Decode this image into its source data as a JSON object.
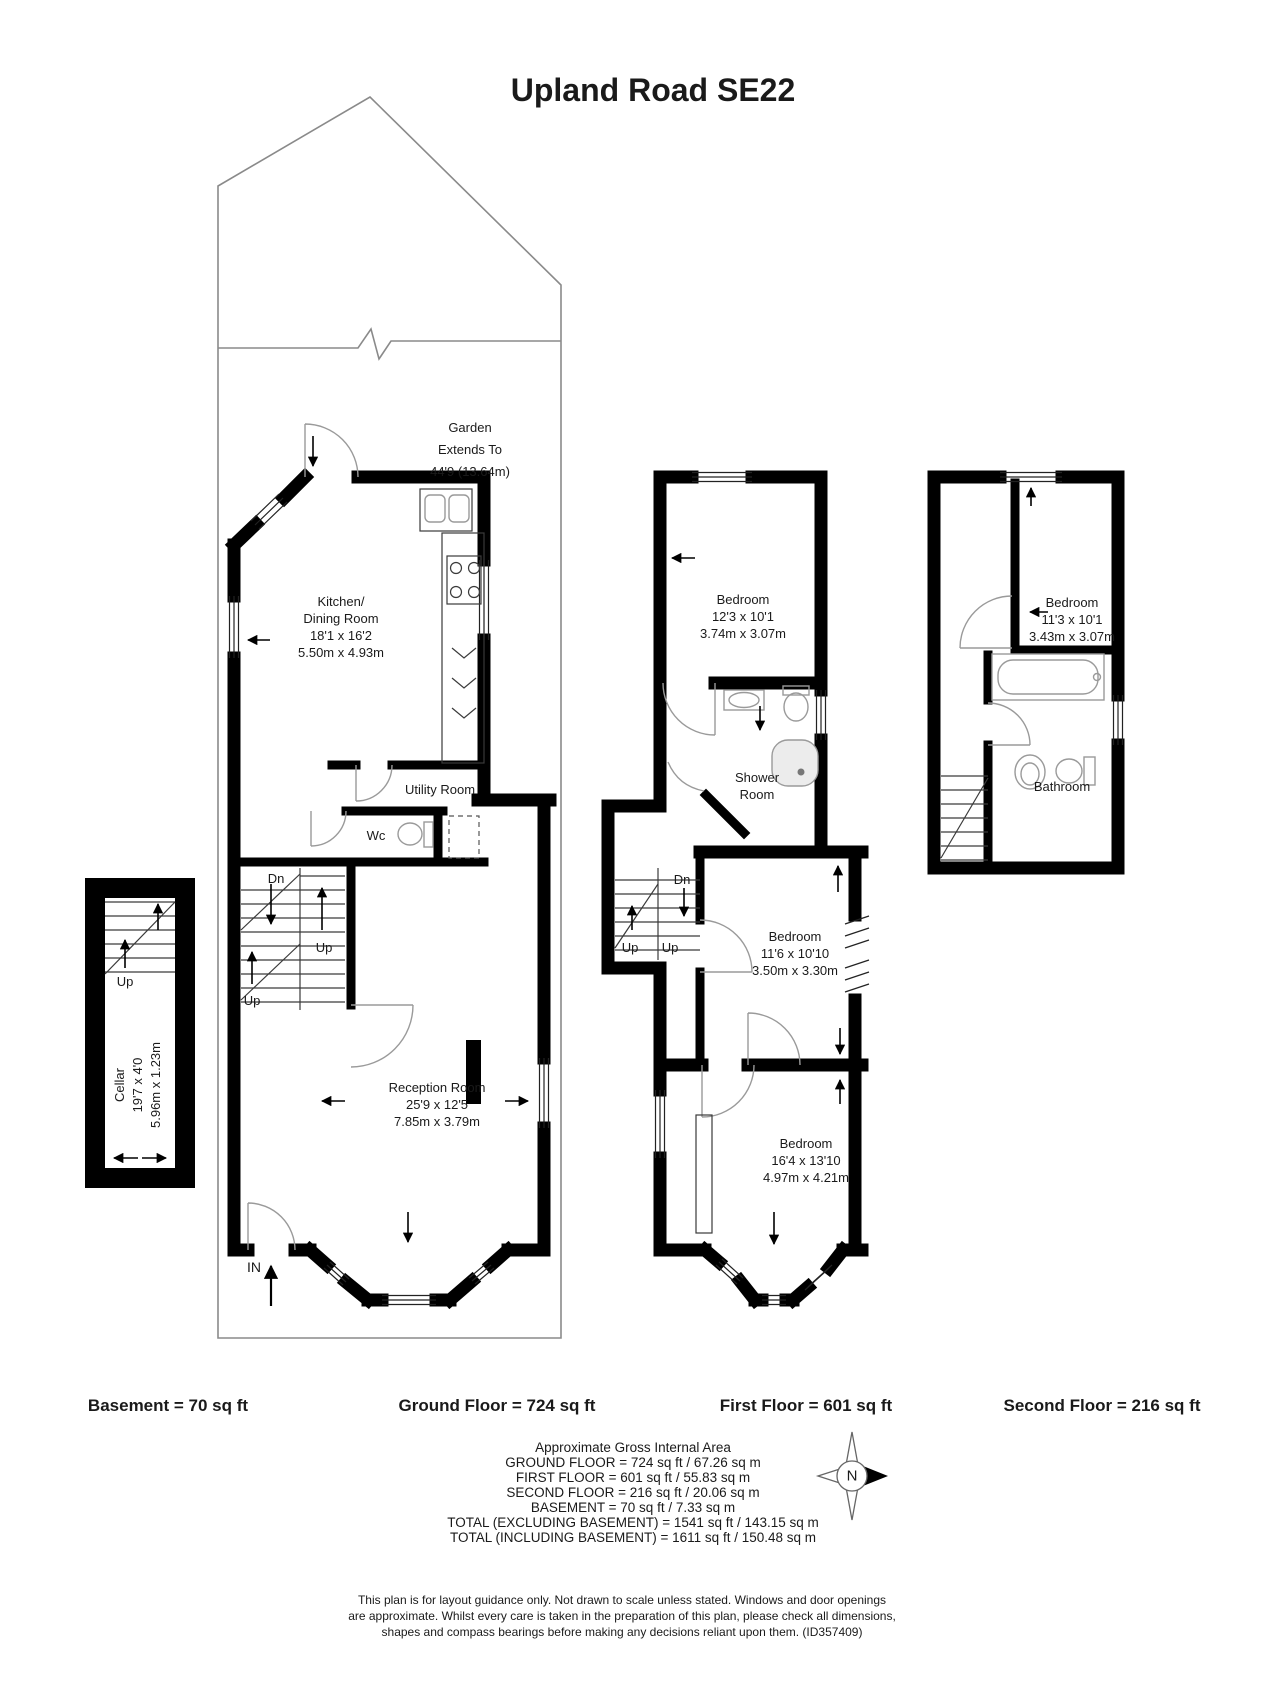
{
  "title": "Upland Road SE22",
  "basement": {
    "floor_label": "Basement = 70 sq ft",
    "cellar": {
      "name": "Cellar",
      "dims_ft": "19'7 x 4'0",
      "dims_m": "5.96m x 1.23m"
    },
    "up": "Up"
  },
  "ground": {
    "floor_label": "Ground Floor = 724 sq ft",
    "garden": {
      "name": "Garden",
      "line2": "Extends To",
      "line3": "44'9 (13.64m)"
    },
    "kitchen": {
      "name_line1": "Kitchen/",
      "name_line2": "Dining Room",
      "dims_ft": "18'1 x 16'2",
      "dims_m": "5.50m x 4.93m"
    },
    "utility": {
      "name": "Utility Room"
    },
    "wc": {
      "name": "Wc"
    },
    "reception": {
      "name": "Reception Room",
      "dims_ft": "25'9 x 12'5",
      "dims_m": "7.85m x 3.79m"
    },
    "dn": "Dn",
    "up_a": "Up",
    "up_b": "Up",
    "entrance": "IN"
  },
  "first": {
    "floor_label": "First Floor = 601 sq ft",
    "bedroom_front": {
      "name": "Bedroom",
      "dims_ft": "12'3 x 10'1",
      "dims_m": "3.74m x 3.07m"
    },
    "shower_room": {
      "line1": "Shower",
      "line2": "Room"
    },
    "bedroom_middle": {
      "name": "Bedroom",
      "dims_ft": "11'6 x 10'10",
      "dims_m": "3.50m x 3.30m"
    },
    "bedroom_rear": {
      "name": "Bedroom",
      "dims_ft": "16'4 x 13'10",
      "dims_m": "4.97m x 4.21m"
    },
    "dn": "Dn",
    "up_a": "Up",
    "up_b": "Up"
  },
  "second": {
    "floor_label": "Second Floor = 216 sq ft",
    "bedroom": {
      "name": "Bedroom",
      "dims_ft": "11'3 x 10'1",
      "dims_m": "3.43m x 3.07m"
    },
    "bathroom": {
      "name": "Bathroom"
    }
  },
  "summary": {
    "heading": "Approximate Gross Internal Area",
    "lines": [
      "GROUND FLOOR = 724  sq ft / 67.26 sq m",
      "FIRST FLOOR = 601 sq ft / 55.83 sq m",
      "SECOND FLOOR = 216 sq ft / 20.06 sq m",
      "BASEMENT = 70 sq ft / 7.33 sq m",
      "TOTAL (EXCLUDING BASEMENT) = 1541 sq ft / 143.15 sq m",
      "TOTAL (INCLUDING BASEMENT) = 1611 sq ft / 150.48 sq m"
    ]
  },
  "compass": {
    "north": "N"
  },
  "disclaimer": {
    "line1": "This plan is for layout guidance only. Not drawn to scale unless stated. Windows and door openings",
    "line2": "are approximate. Whilst every care is taken in the preparation of this plan, please check all dimensions,",
    "line3": "shapes and compass bearings before making any decisions reliant upon them. (ID357409)"
  }
}
